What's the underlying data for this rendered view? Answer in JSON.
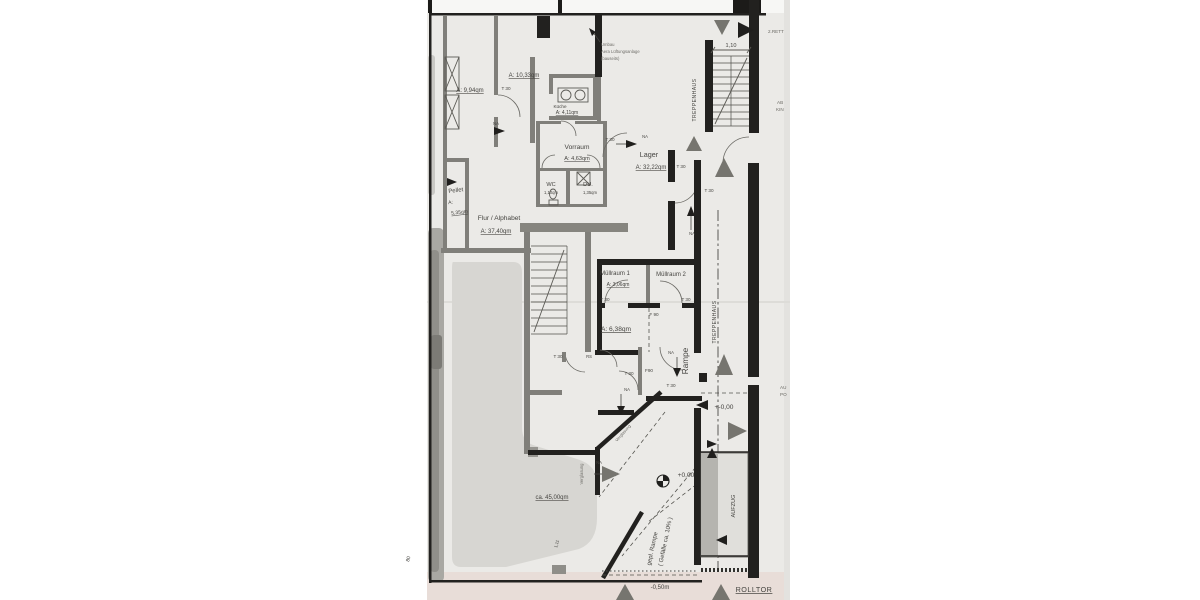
{
  "rooms": {
    "room_994": {
      "area": "A: 9,94qm"
    },
    "room_1033": {
      "area": "A: 10,33qm"
    },
    "kueche": {
      "name": "Küche",
      "area": "A: 4,11qm"
    },
    "vorraum": {
      "name": "Vorraum",
      "area": "A: 4,63qm"
    },
    "lager": {
      "name": "Lager",
      "area": "A: 32,22qm"
    },
    "wc": {
      "name": "WC",
      "area": "1,10qm"
    },
    "dusche": {
      "name": "DU.",
      "area": "1,35qm"
    },
    "pellet": {
      "name": "Pellet",
      "label_a": "A:",
      "area": "5,35qm"
    },
    "flur": {
      "name": "Flur / Alphabet",
      "area": "A: 37,40qm"
    },
    "muellraum1": {
      "name": "Müllraum 1",
      "area": "A: 3,06qm"
    },
    "muellraum2": {
      "name": "Müllraum 2"
    },
    "abstell": {
      "area": "A: 6,38qm"
    },
    "verkauf": {
      "area": "ca. 45,00qm"
    }
  },
  "circulation": {
    "treppenhaus": "TREPPENHAUS",
    "aufzug": "AUFZUG",
    "rampe": "Rampe",
    "gepl_rampe": "gepl. Rampe",
    "gefaelle": "( Gefälle ca. 10% )",
    "rolltor": "ROLLTOR"
  },
  "levels": {
    "entry": "+-0,00",
    "ground": "+0,00",
    "street": "-0,50m"
  },
  "dimensions": {
    "stair_width": "1,10",
    "margin_80": "80",
    "glass_111": "1,11"
  },
  "door_labels": {
    "t30": "T 30",
    "f90": "F 90",
    "f90_compact": "F90",
    "na": "NA",
    "rs": "RS"
  },
  "annotations": {
    "vent": {
      "line1": "Umbau",
      "line2": "Aera Lüftungsanlage",
      "line3": "(bauseits)"
    },
    "verglasung": "Verglasung",
    "edge": {
      "rett": "2.RETT",
      "ab": "AB",
      "kin": "KIN",
      "au": "AU",
      "po": "PO"
    }
  },
  "icons": {
    "direction-arrow": "filled triangle",
    "level-marker": "half-filled circle"
  },
  "colors": {
    "paper": "#ebeae7",
    "bottom_strip": "#e8ddd8",
    "wall_black": "#22211f",
    "wall_grey": "#807f7a",
    "redaction_blob": "#d7d6d2",
    "arrow_grey": "#76756f",
    "text": "#454440"
  }
}
